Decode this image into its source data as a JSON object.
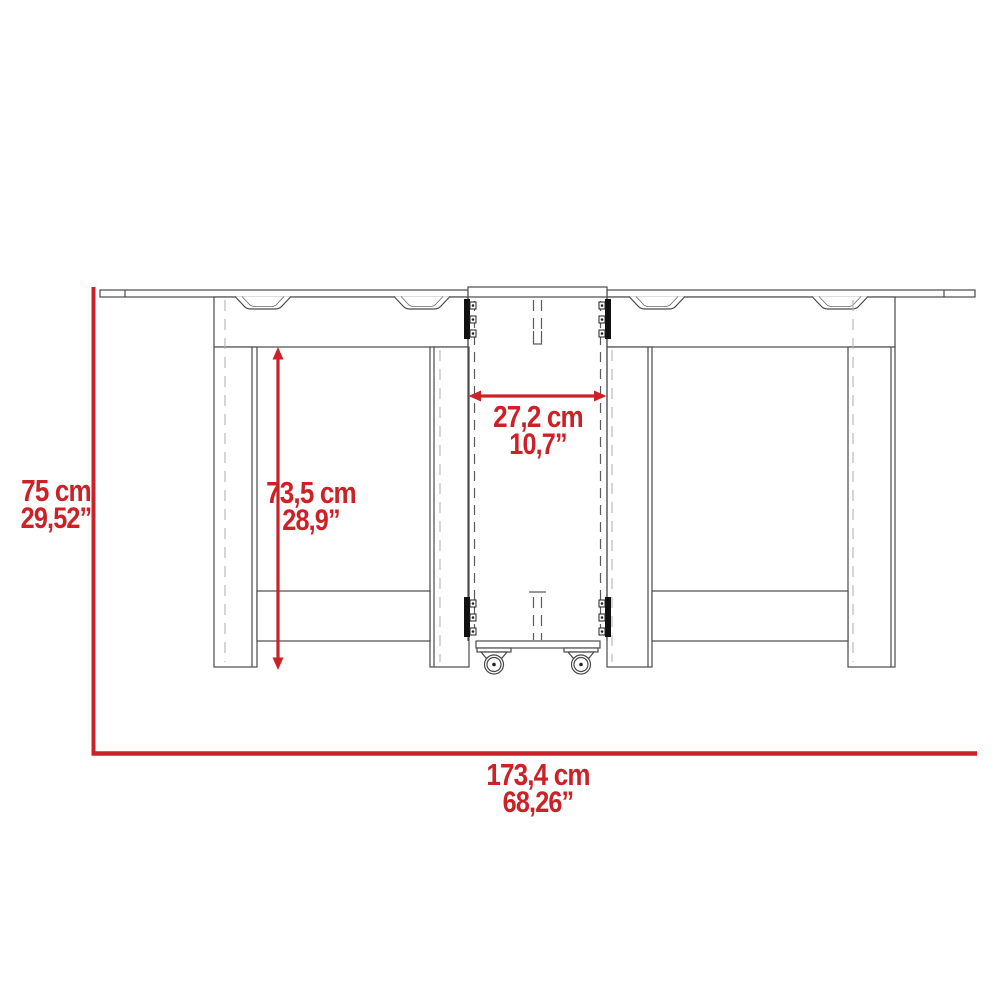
{
  "diagram": {
    "subject": "drop-leaf folding table with casters, front elevation, dimension drawing",
    "accent_color": "#cc2127",
    "line_color": "#4a4a4a",
    "dimensions": {
      "overall_height": {
        "metric": "75 cm",
        "imperial": "29,52”"
      },
      "leg_height": {
        "metric": "73,5 cm",
        "imperial": "28,9”"
      },
      "center_section_width": {
        "metric": "27,2 cm",
        "imperial": "10,7”"
      },
      "overall_width": {
        "metric": "173,4 cm",
        "imperial": "68,26”"
      }
    }
  }
}
